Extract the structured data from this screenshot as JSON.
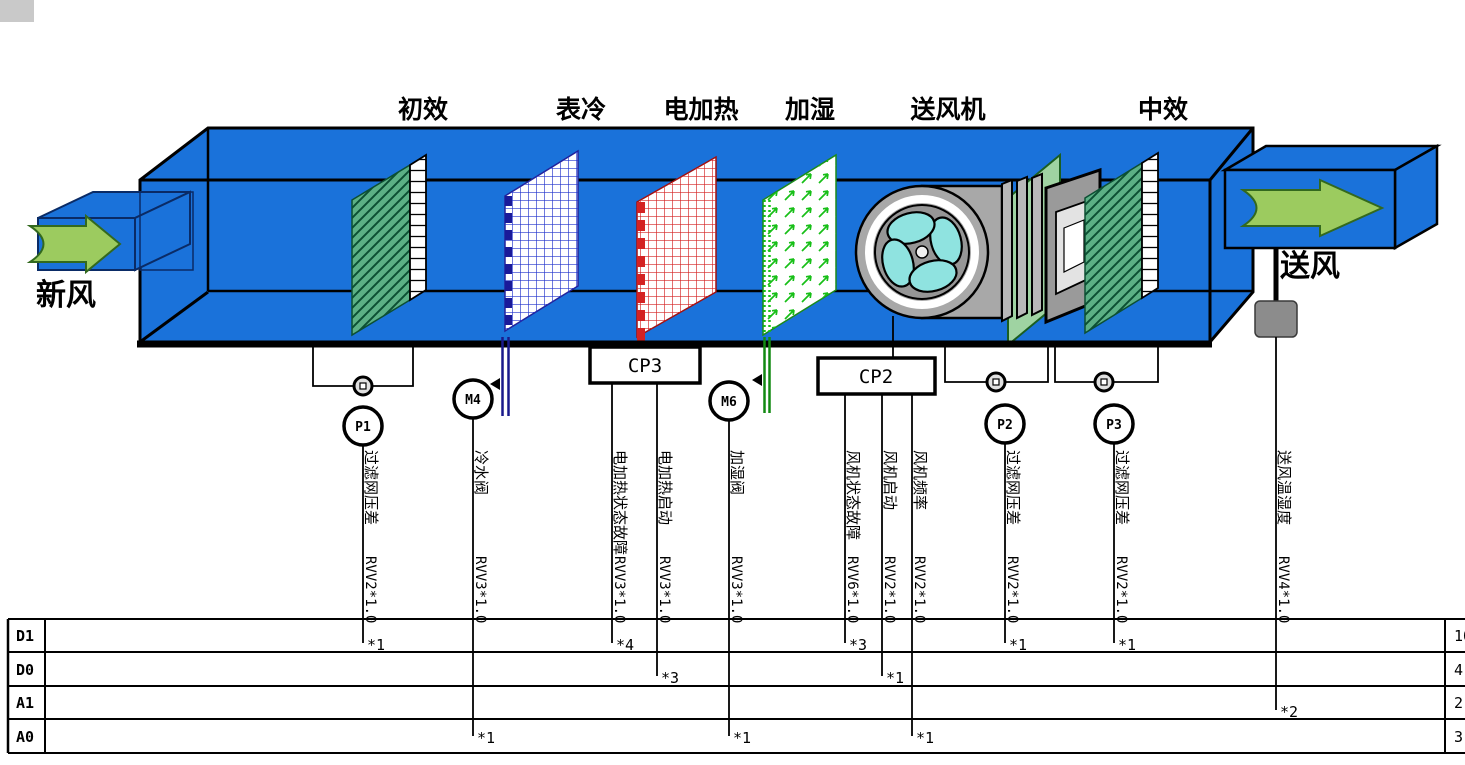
{
  "component_labels": {
    "primary_filter": "初效",
    "cooling_coil": "表冷",
    "electric_heater": "电加热",
    "humidifier": "加湿",
    "supply_fan": "送风机",
    "medium_filter": "中效"
  },
  "flow_labels": {
    "fresh_air": "新风",
    "supply_air": "送风"
  },
  "controllers": {
    "cp3": "CP3",
    "cp2": "CP2"
  },
  "sensors": {
    "p1": "P1",
    "m4": "M4",
    "m6": "M6",
    "p2": "P2",
    "p3": "P3"
  },
  "wires": [
    {
      "signal": "过滤网压差",
      "cable": "RVV2*1.0",
      "terminal_row": "D1",
      "marker": "*1"
    },
    {
      "signal": "冷水阀",
      "cable": "RVV3*1.0",
      "terminal_row": "A0",
      "marker": "*1"
    },
    {
      "signal": "电加热状态故障",
      "cable": "RVV3*1.0",
      "terminal_row": "D1",
      "marker": "*4"
    },
    {
      "signal": "电加热启动",
      "cable": "RVV3*1.0",
      "terminal_row": "D0",
      "marker": "*3"
    },
    {
      "signal": "加湿阀",
      "cable": "RVV3*1.0",
      "terminal_row": "A0",
      "marker": "*1"
    },
    {
      "signal": "风机状态故障",
      "cable": "RVV6*1.0",
      "terminal_row": "D1",
      "marker": "*3"
    },
    {
      "signal": "风机启动",
      "cable": "RVV2*1.0",
      "terminal_row": "D0",
      "marker": "*1"
    },
    {
      "signal": "风机频率",
      "cable": "RVV2*1.0",
      "terminal_row": "A0",
      "marker": "*1"
    },
    {
      "signal": "过滤网压差",
      "cable": "RVV2*1.0",
      "terminal_row": "D1",
      "marker": "*1"
    },
    {
      "signal": "过滤网压差",
      "cable": "RVV2*1.0",
      "terminal_row": "D1",
      "marker": "*1"
    },
    {
      "signal": "送风温湿度",
      "cable": "RVV4*1.0",
      "terminal_row": "A1",
      "marker": "*2"
    }
  ],
  "terminal_table": {
    "rows": [
      {
        "label": "D1",
        "count": "10"
      },
      {
        "label": "D0",
        "count": "4"
      },
      {
        "label": "A1",
        "count": "2"
      },
      {
        "label": "A0",
        "count": "3"
      }
    ]
  },
  "colors": {
    "duct_blue": "#1a72da",
    "arrow_green": "#9ccb5f",
    "filter_teal": "#5cb085",
    "coil_blue": "#2233cc",
    "heater_red": "#d42222",
    "humidifier_green": "#17bf17",
    "fan_gray": "#a8a8a8",
    "blade_cyan": "#8fe3e0",
    "sensor_box_gray": "#8c8c8c"
  }
}
